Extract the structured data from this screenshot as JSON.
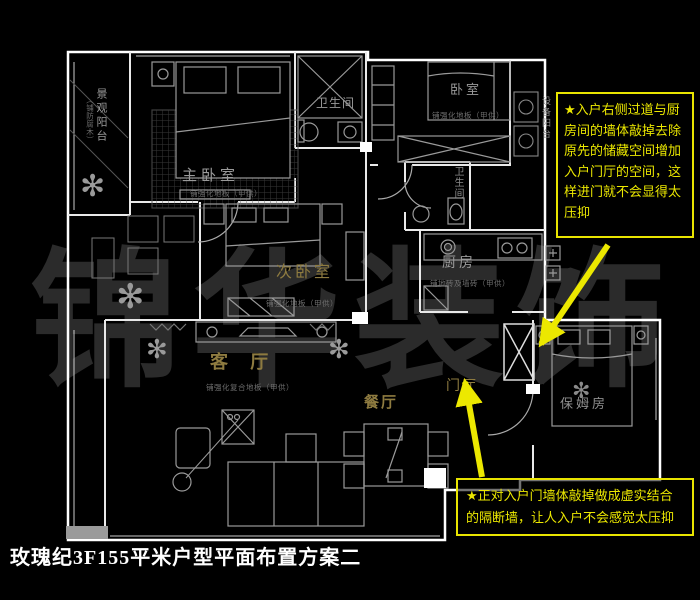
{
  "page": {
    "title": "玫瑰纪3F155平米户型平面布置方案二"
  },
  "watermark": {
    "text": "锦华装饰"
  },
  "rooms": {
    "view_balcony": {
      "label": "景观阳台",
      "note": "（铺防腐木）"
    },
    "master_bedroom": {
      "label": "主卧室",
      "note": "铺强化地板（甲供）"
    },
    "bath_top": {
      "label": "卫生间"
    },
    "bedroom": {
      "label": "卧室",
      "note": "铺强化地板（甲供）"
    },
    "equip_balcony": {
      "label": "设备阳台"
    },
    "second_bedroom": {
      "label": "次卧室",
      "note": "铺强化地板（甲供）"
    },
    "bath_mid": {
      "label": "卫生间"
    },
    "kitchen": {
      "label": "厨房",
      "note": "铺地砖及墙砖（甲供）"
    },
    "living_room": {
      "label": "客 厅",
      "note": "铺强化复合地板（甲供）"
    },
    "dining_room": {
      "label": "餐厅"
    },
    "foyer": {
      "label": "门厅"
    },
    "nanny_room": {
      "label": "保姆房"
    }
  },
  "annotations": {
    "box1": "★入户右侧过道与厨房间的墙体敲掉去除原先的储藏空间增加入户门厅的空间，这样进门就不会显得太压抑",
    "box2": "★正对入户门墙体敲掉做成虚实结合的隔断墙，让人入户不会感觉太压抑"
  },
  "icons": {
    "plant": "✻"
  },
  "colors": {
    "background": "#000000",
    "wall": "#ffffff",
    "furniture": "#9a9a9a",
    "accent_yellow": "#ece800",
    "gold_label": "#8e7b40",
    "gray_label": "#9a9a9a",
    "watermark": "#2b2b2b"
  }
}
